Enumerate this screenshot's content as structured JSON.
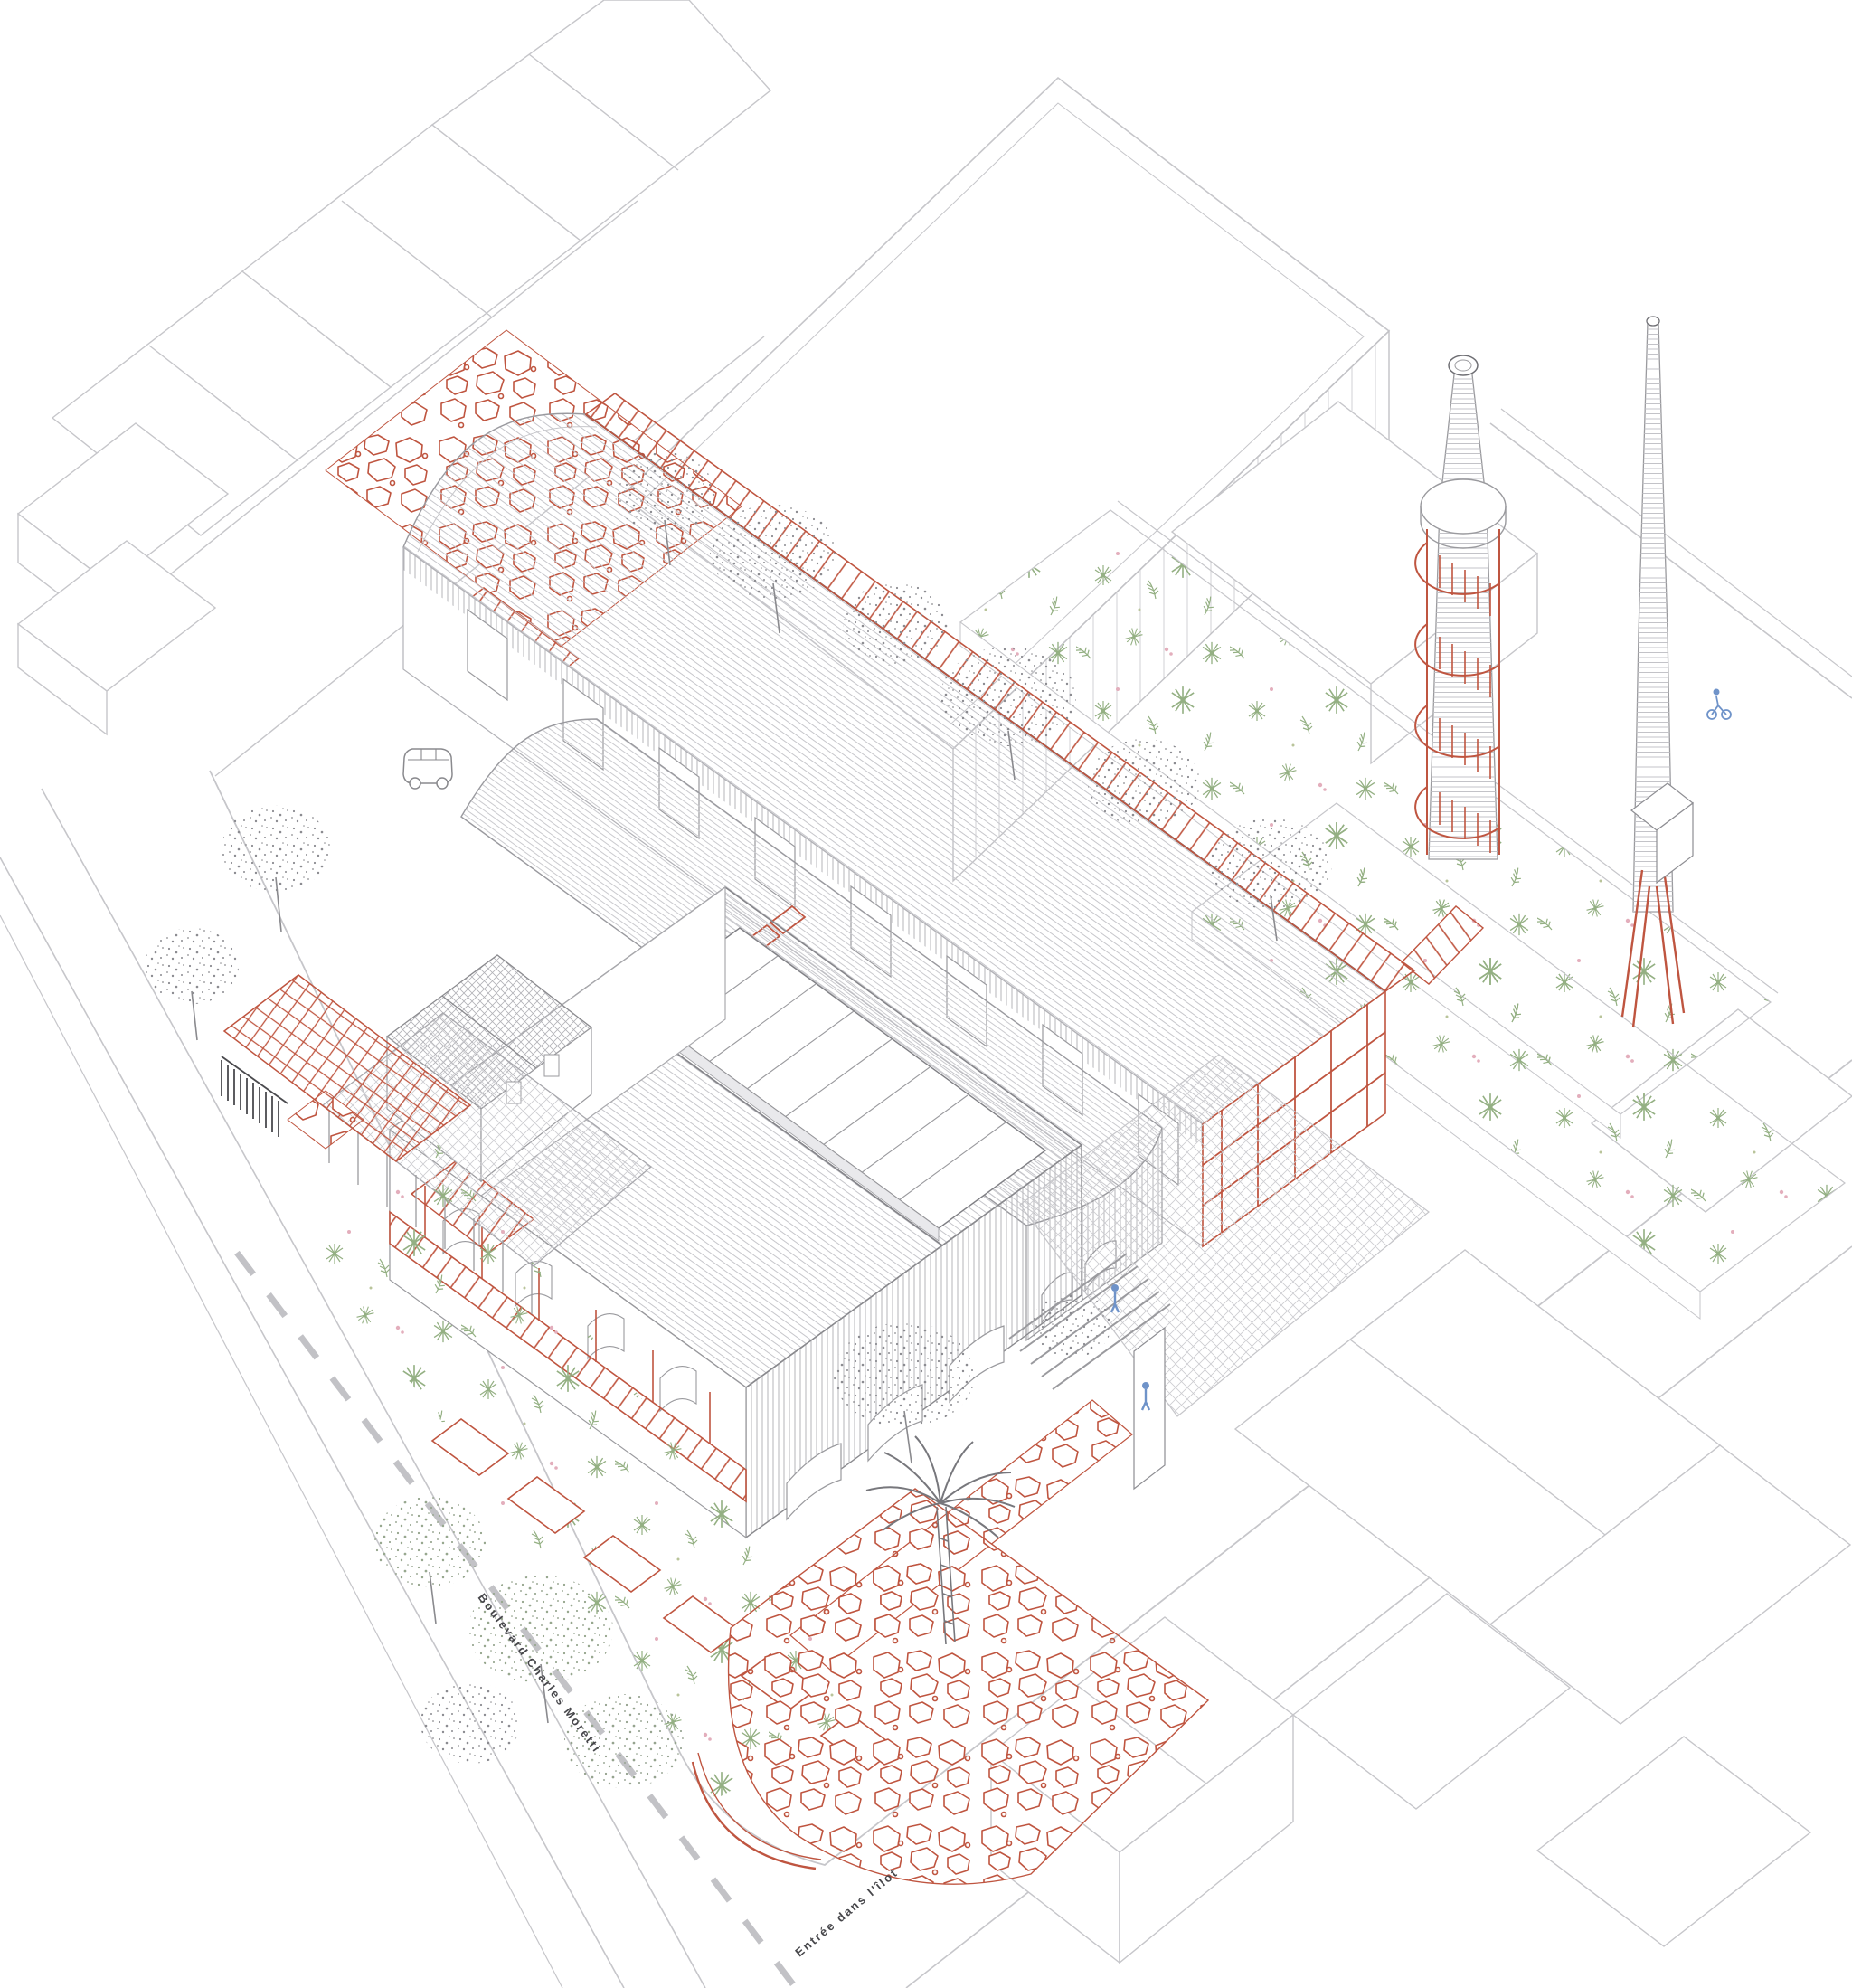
{
  "document": {
    "type": "architectural-axonometric-site-drawing",
    "orientation": "isometric, main axes at ±36 degrees"
  },
  "labels": {
    "street_name": "Boulevard Charles Moretti",
    "site_entrance": "Entrée dans l'îlot"
  },
  "colors": {
    "background": "#ffffff",
    "accent_red": "#bf5540",
    "line_gray": "#c6c6ca",
    "dark_gray": "#6f6f74",
    "foliage_green": "#94b083",
    "flower_pink": "#e3aebc",
    "people_blue": "#6f93c9",
    "tree_gray": "#8b8b90",
    "fence_dark": "#4a4a4e"
  },
  "scene": {
    "elements": [
      {
        "name": "large-vaulted-hall",
        "feature": "curved sheet roof with rooftop red walkway"
      },
      {
        "name": "second-vaulted-hall",
        "feature": "smaller barrel vault with slatted gable"
      },
      {
        "name": "gabled-workshop-hall",
        "feature": "hatched gable roof with monitor skylight, red gallery balcony, arched openings"
      },
      {
        "name": "roof-monitor-skylight",
        "feature": "glazed ridge monitor"
      },
      {
        "name": "tiled-roof-house",
        "feature": "small house with square-tile roof"
      },
      {
        "name": "glass-veranda",
        "feature": "gridded glass canopy on slender posts"
      },
      {
        "name": "brick-chimney-with-spiral-staircase",
        "feature": "tall tapering chimney, red helical stair and round platform"
      },
      {
        "name": "slender-chimney-spire",
        "feature": "thin tapering chimney with red base struts"
      },
      {
        "name": "stone-rubble-surfaces",
        "feature": "red trencadis stone walls, ramp and corner plaza"
      },
      {
        "name": "red-paving-slabs",
        "feature": "stepping slabs through garden"
      },
      {
        "name": "planted-gardens",
        "feature": "two long planted strips and street-side garden"
      },
      {
        "name": "courtyard-paving",
        "feature": "diamond tile plaza with steps and benches"
      },
      {
        "name": "palm-tree",
        "feature": "sketched palm"
      },
      {
        "name": "street-trees",
        "feature": "stippled grey canopies"
      },
      {
        "name": "parked-van",
        "feature": "small utility van outline"
      },
      {
        "name": "pedestrians",
        "feature": "two tiny blue figures"
      },
      {
        "name": "cyclist",
        "feature": "tiny blue figure with bicycle"
      },
      {
        "name": "context-buildings",
        "feature": "white prisms of neighbouring blocks"
      },
      {
        "name": "streets",
        "feature": "boulevard with dashed centre line, corner entrance"
      }
    ]
  }
}
